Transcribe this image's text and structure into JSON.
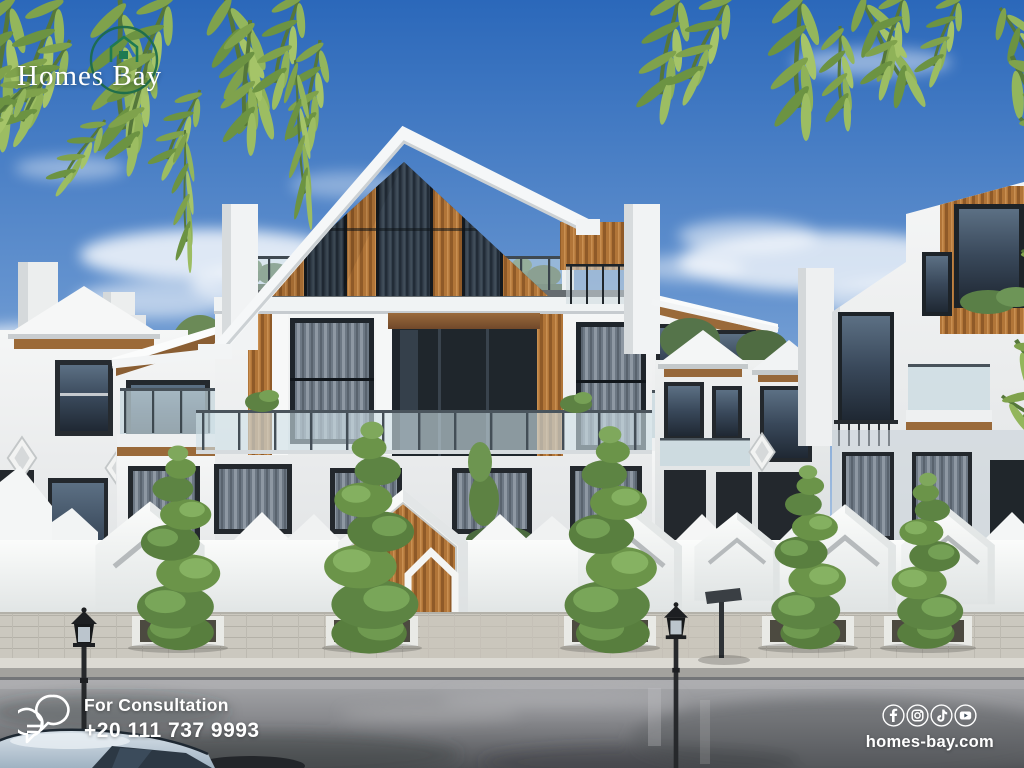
{
  "branding": {
    "logo_text": "Homes Bay"
  },
  "consultation": {
    "label": "For Consultation",
    "phone": "+20 111 737 9993"
  },
  "footer": {
    "website": "homes-bay.com",
    "social_icons": [
      "facebook-icon",
      "instagram-icon",
      "tiktok-icon",
      "youtube-icon"
    ]
  },
  "palette": {
    "logo_green": "#1c6b4c",
    "sky_blue": "#2b68ba",
    "wood_accent": "#a96f35",
    "wall_white": "#f5f6f6",
    "asphalt": "#525458",
    "text_white": "#ffffff"
  }
}
